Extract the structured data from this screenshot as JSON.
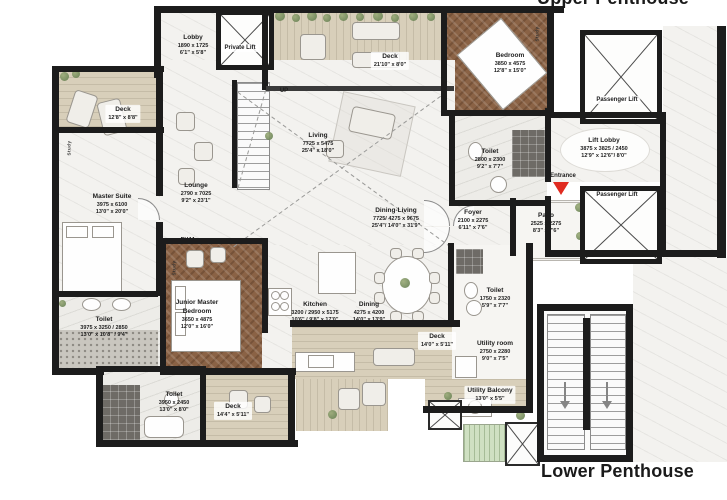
{
  "titles": {
    "upper": "Upper Penthouse",
    "lower": "Lower Penthouse"
  },
  "labels": {
    "private_lift": "Private Lift",
    "passenger_lift_top": "Passenger Lift",
    "passenger_lift_bottom": "Passenger Lift",
    "entrance": "Entrance",
    "up": "UP",
    "puja": "PUJA",
    "study": "Study"
  },
  "rooms": {
    "lobby": {
      "name": "Lobby",
      "mm": "1890 x 1725",
      "ft": "6'1\" x 5'8\""
    },
    "deck_top_left": {
      "name": "Deck",
      "ft": "12'8\" x 8'8\""
    },
    "master_suite": {
      "name": "Master Suite",
      "mm": "3975 x 6100",
      "ft": "13'0\" x 20'0\""
    },
    "lounge": {
      "name": "Lounge",
      "mm": "2790 x 7025",
      "ft": "9'2\" x 23'1\""
    },
    "living": {
      "name": "Living",
      "mm": "7725 x 5475",
      "ft": "25'4\" x 18'0\""
    },
    "deck_top": {
      "name": "Deck",
      "ft": "21'10\" x 8'0\""
    },
    "bedroom": {
      "name": "Bedroom",
      "mm": "3850 x 4575",
      "ft": "12'8\" x 15'0\""
    },
    "toilet_bedroom": {
      "name": "Toilet",
      "mm": "2800 x 2300",
      "ft": "9'2\" x 7'7\""
    },
    "lift_lobby": {
      "name": "Lift Lobby",
      "mm": "3875 x 3825 / 2450",
      "ft": "12'9\" x 12'6\"/ 8'0\""
    },
    "patio": {
      "name": "Patio",
      "mm": "2525 x 2275",
      "ft": "8'3\" x 7'6\""
    },
    "foyer": {
      "name": "Foyer",
      "mm": "2100 x 2275",
      "ft": "6'11\" x 7'6\""
    },
    "dining_living": {
      "name": "Dining-Living",
      "mm": "7725/ 4275 x 9675",
      "ft": "25'4\"/ 14'0\" x 31'9\""
    },
    "toilet_master": {
      "name": "Toilet",
      "mm": "3975 x 3250 / 2850",
      "ft": "13'0\" x 10'8\" / 9'4\""
    },
    "junior_master": {
      "name": "Junior Master Bedroom",
      "mm": "3650 x 4875",
      "ft": "12'0\" x 16'0\""
    },
    "kitchen": {
      "name": "Kitchen",
      "mm": "3200 / 2950 x 5175",
      "ft": "10'6\" / 9'8\" x 17'0\""
    },
    "dining": {
      "name": "Dining",
      "mm": "4275 x 4200",
      "ft": "14'0\" x 13'9\""
    },
    "toilet_junior": {
      "name": "Toilet",
      "mm": "3950 x 2450",
      "ft": "13'0\" x 8'0\""
    },
    "deck_bottom_left": {
      "name": "Deck",
      "ft": "14'4\" x 5'11\""
    },
    "deck_bottom_right": {
      "name": "Deck",
      "ft": "14'0\" x 5'11\""
    },
    "toilet_utility": {
      "name": "Toilet",
      "mm": "1750 x 2320",
      "ft": "5'9\" x 7'7\""
    },
    "utility_room": {
      "name": "Utility room",
      "mm": "2750 x 2280",
      "ft": "9'0\" x 7'5\""
    },
    "utility_balcony": {
      "name": "Utility Balcony",
      "ft": "13'0\" x 5'5\""
    }
  },
  "colors": {
    "wall": "#1c1c1c",
    "wood_floor": "#8a6245",
    "deck_floor": "#d8cfba",
    "marble_floor": "#f3f2ef",
    "entrance_marker": "#e02b20"
  }
}
